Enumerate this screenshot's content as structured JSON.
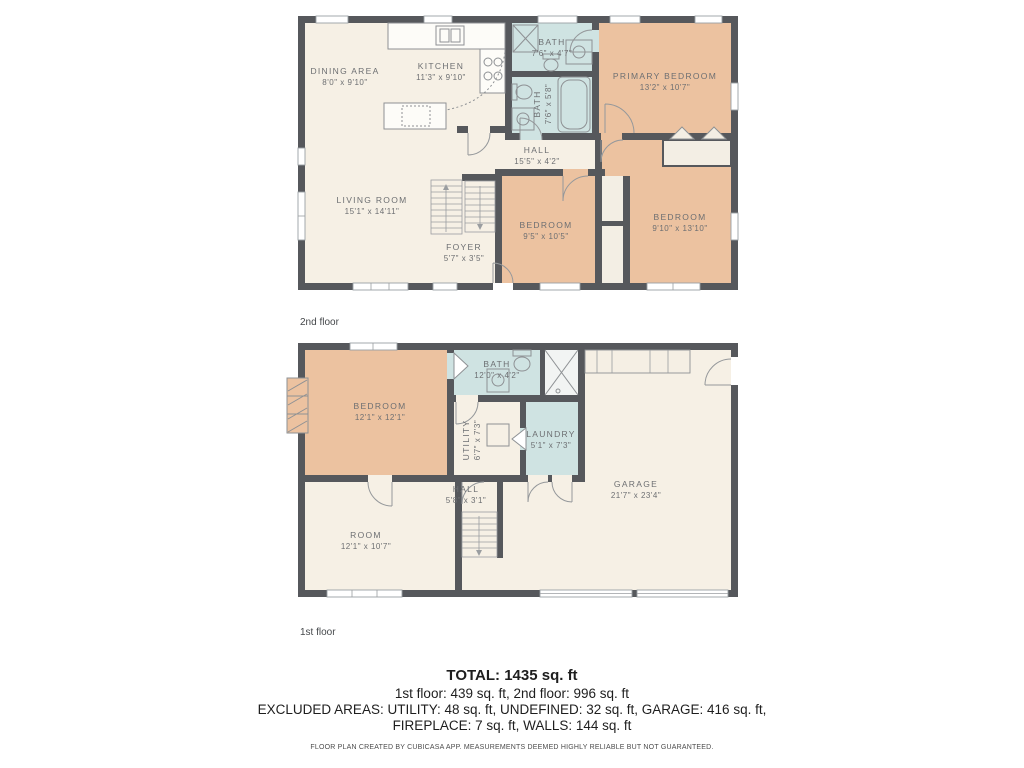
{
  "colors": {
    "wall": "#56585c",
    "room_cream": "#f6f0e5",
    "room_orange": "#ecc2a0",
    "room_blue": "#cfe3e2",
    "closet_white": "#f3eee4",
    "background": "#ffffff",
    "label_text": "#6d6f72"
  },
  "floors": [
    {
      "caption": "2nd floor",
      "rooms": [
        {
          "name": "DINING AREA",
          "dims": "8'0\" x 9'10\""
        },
        {
          "name": "KITCHEN",
          "dims": "11'3\" x 9'10\""
        },
        {
          "name": "BATH",
          "dims": "7'6\" x 4'7\""
        },
        {
          "name": "BATH",
          "dims": "7'6\" x 5'8\""
        },
        {
          "name": "PRIMARY BEDROOM",
          "dims": "13'2\" x 10'7\""
        },
        {
          "name": "HALL",
          "dims": "15'5\" x 4'2\""
        },
        {
          "name": "LIVING ROOM",
          "dims": "15'1\" x 14'11\""
        },
        {
          "name": "FOYER",
          "dims": "5'7\" x 3'5\""
        },
        {
          "name": "BEDROOM",
          "dims": "9'5\" x 10'5\""
        },
        {
          "name": "BEDROOM",
          "dims": "9'10\" x 13'10\""
        }
      ]
    },
    {
      "caption": "1st floor",
      "rooms": [
        {
          "name": "BEDROOM",
          "dims": "12'1\" x 12'1\""
        },
        {
          "name": "BATH",
          "dims": "12'0\" x 4'2\""
        },
        {
          "name": "UTILITY",
          "dims": "6'7\" x 7'3\""
        },
        {
          "name": "LAUNDRY",
          "dims": "5'1\" x 7'3\""
        },
        {
          "name": "GARAGE",
          "dims": "21'7\" x 23'4\""
        },
        {
          "name": "HALL",
          "dims": "5'8\" x 3'1\""
        },
        {
          "name": "ROOM",
          "dims": "12'1\" x 10'7\""
        }
      ]
    }
  ],
  "summary": {
    "total": "TOTAL: 1435 sq. ft",
    "floors_line": "1st floor: 439 sq. ft, 2nd floor: 996 sq. ft",
    "excluded_line1": "EXCLUDED AREAS: UTILITY: 48 sq. ft, UNDEFINED: 32 sq. ft, GARAGE: 416 sq. ft,",
    "excluded_line2": "FIREPLACE: 7 sq. ft, WALLS: 144 sq. ft",
    "disclaimer": "FLOOR PLAN CREATED BY CUBICASA APP. MEASUREMENTS DEEMED HIGHLY RELIABLE BUT NOT GUARANTEED."
  }
}
